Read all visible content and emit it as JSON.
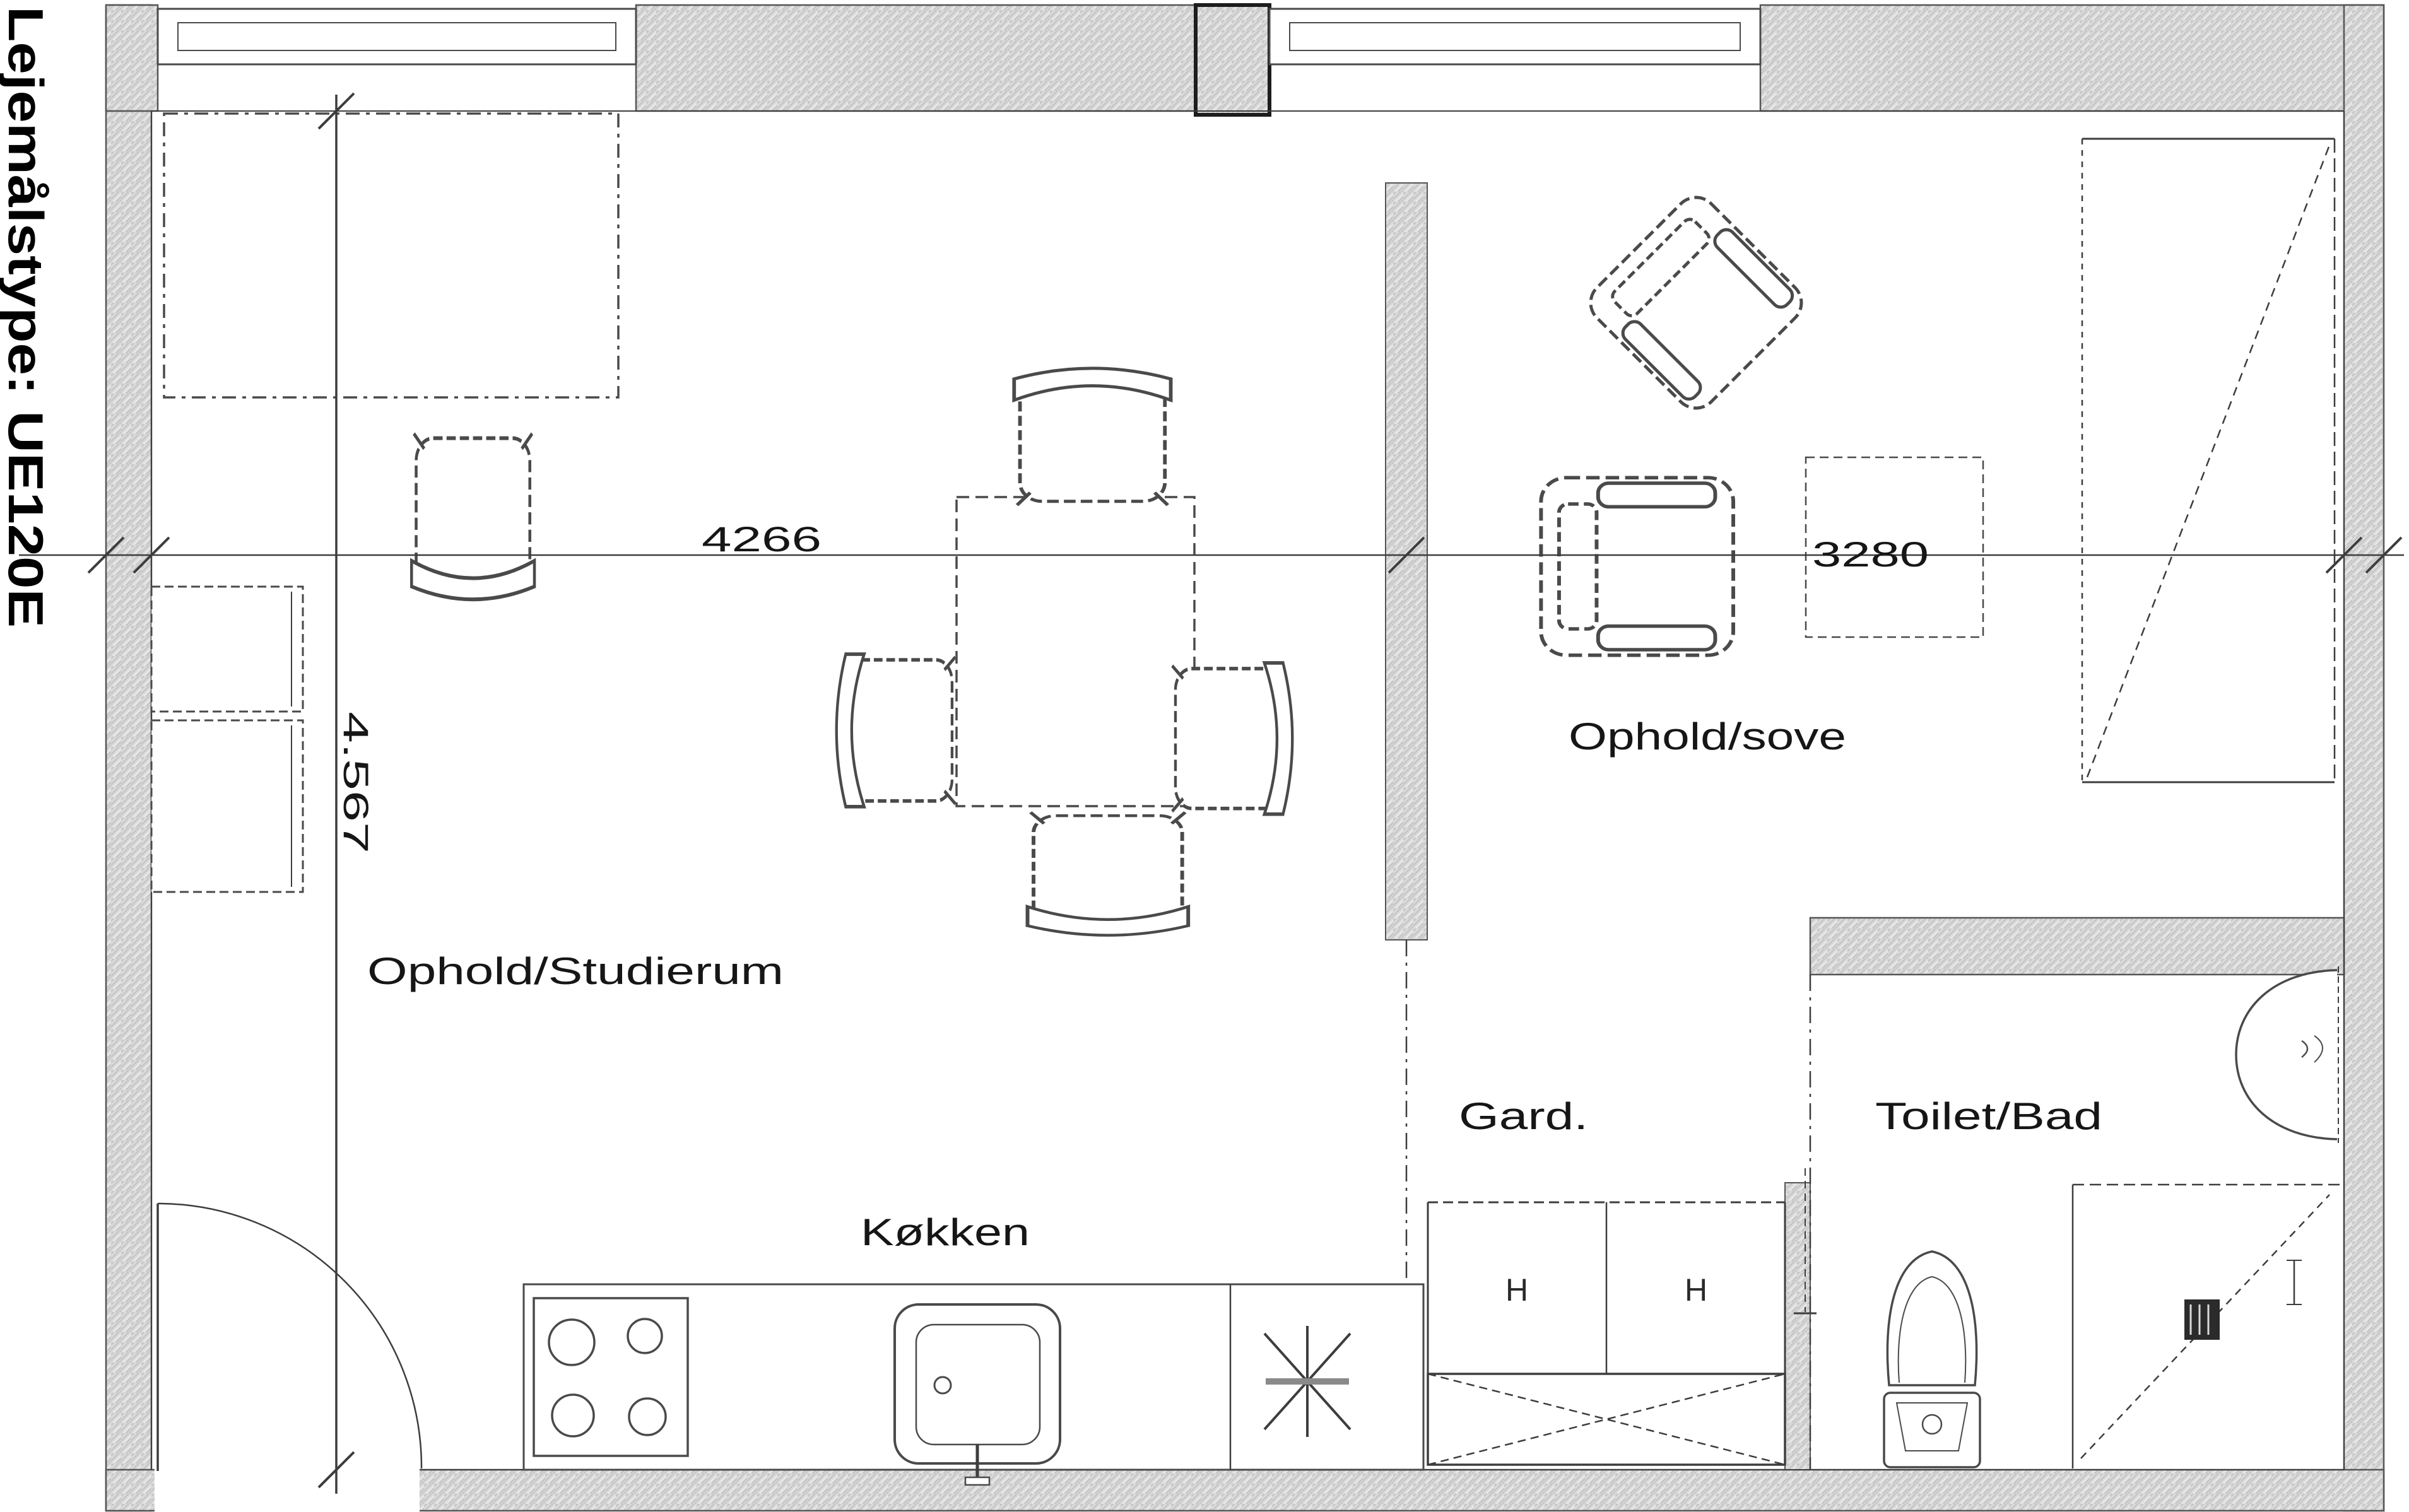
{
  "title": "Lejemålstype: UE120E",
  "rooms": {
    "living_study": "Ophold/Studierum",
    "living_sleep": "Ophold/sove",
    "wardrobe": "Gard.",
    "bath": "Toilet/Bad",
    "kitchen": "Køkken"
  },
  "dimensions": {
    "left_room_width_mm": "4266",
    "right_room_width_mm": "3280",
    "room_depth_m": "4.567"
  },
  "wardrobe": {
    "rail_left": "H",
    "rail_right": "H"
  },
  "colors": {
    "line": "#3d3d3d",
    "wall_fill": "#d9d9d9",
    "text": "#161616",
    "background": "#ffffff"
  }
}
